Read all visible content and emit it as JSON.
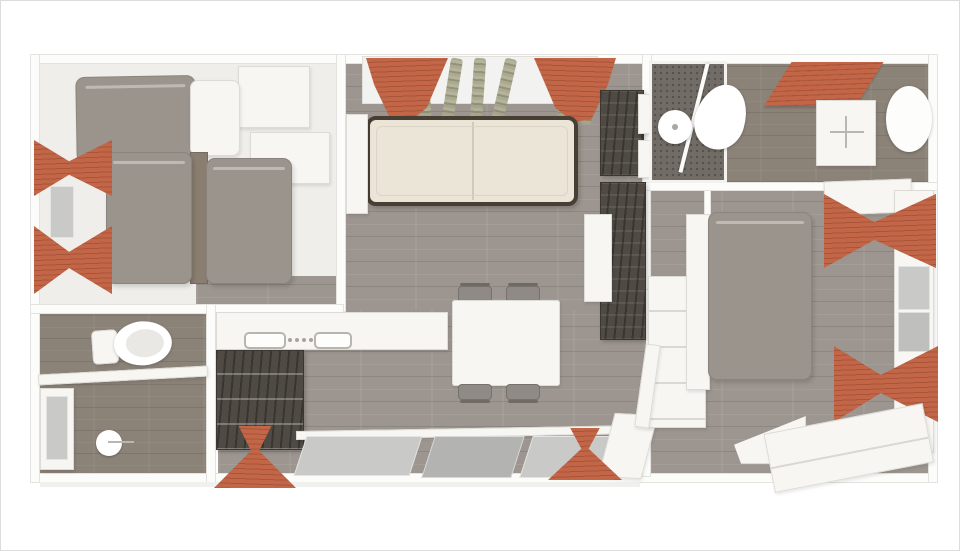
{
  "meta": {
    "title": "Mobile home floor plan - top-down 3D render",
    "type": "floorplan-render"
  },
  "palette": {
    "accent_orange": "#c36647",
    "accent_orange_deep": "#a75439",
    "floor_wood": "#9d9690",
    "floor_taupe": "#8b8278",
    "bedding_gray": "#9b948d",
    "sofa_cream": "#eae5d7",
    "sofa_trim": "#473e34",
    "cabinet_dark": "#4f4a44",
    "furniture_white": "#f7f6f3",
    "wall_white": "#fcfcfb",
    "glass_gray": "#c9c9c7",
    "sheer_olive": "#a3a289"
  },
  "rooms": [
    {
      "id": "kids-bedroom",
      "label": "Children's bedroom with three single beds, wardrobe and orange window curtains",
      "items": [
        "single-bed",
        "single-bed",
        "single-bed",
        "pillow",
        "nightstand",
        "wardrobe",
        "chest",
        "orange-curtain",
        "orange-curtain",
        "window"
      ]
    },
    {
      "id": "wc",
      "label": "WC with toilet, shelf, window and toilet-roll holder",
      "items": [
        "toilet",
        "shelf",
        "window",
        "toilet-roll-holder"
      ]
    },
    {
      "id": "living-kitchen",
      "label": "Open-plan living room and kitchen with cream sofa, dining table, worktop and dark cabinets",
      "items": [
        "sofa",
        "window-curtains",
        "sheer-curtains",
        "kitchen-counter",
        "sink",
        "hob-knobs",
        "base-cabinets",
        "tall-cabinet",
        "tv-unit",
        "storage-cubes",
        "sideboard",
        "dining-table",
        "chair",
        "chair",
        "chair",
        "chair",
        "front-windows",
        "entrance-door",
        "door-curtain",
        "door-curtain"
      ]
    },
    {
      "id": "shower-room",
      "label": "Shower room with glass screen, washbasin, vanity, orange bath mat and oval mirror",
      "items": [
        "shower-tray",
        "shower-screen",
        "washbasin",
        "bath-mat",
        "vanity-unit",
        "mirror"
      ]
    },
    {
      "id": "hallway",
      "label": "Hallway with built-in wardrobe and door",
      "items": [
        "wardrobe",
        "door"
      ]
    },
    {
      "id": "master-bedroom",
      "label": "Master bedroom with double bed, dresser and orange window curtains",
      "items": [
        "double-bed",
        "bedside-bench",
        "overhead-shelf",
        "window",
        "orange-curtain",
        "orange-curtain",
        "dresser",
        "corner-bench"
      ]
    }
  ]
}
